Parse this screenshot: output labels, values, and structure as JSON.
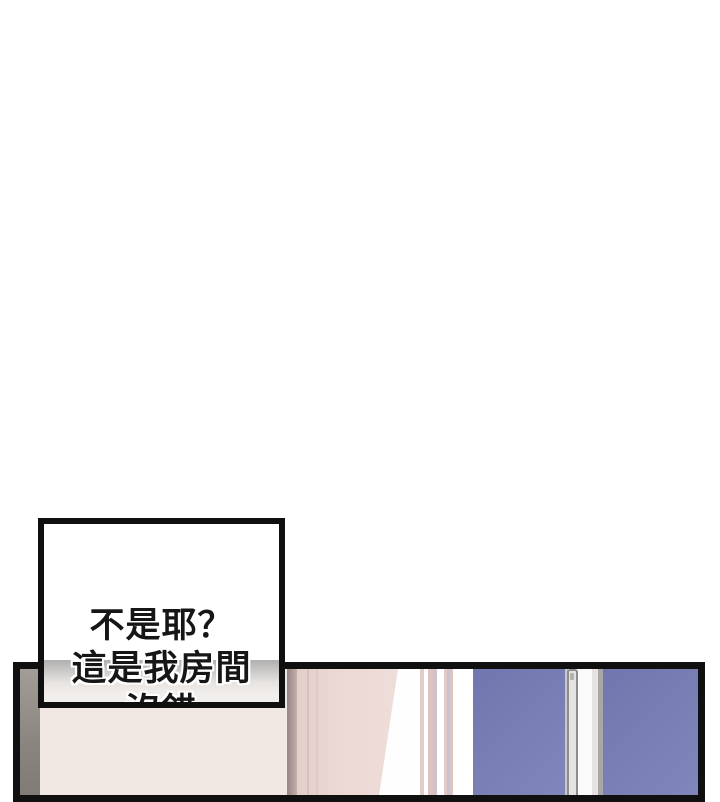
{
  "page": {
    "type": "comic-page",
    "background": "#ffffff"
  },
  "speech_bubble": {
    "lines": [
      "不是耶？",
      "這是我房間",
      "沒錯"
    ],
    "border_color": "#0f0f0f",
    "text_color": "#161616"
  },
  "panel": {
    "border_color": "#101010",
    "scene": {
      "left_wall": "shadowed-wall-edge",
      "wall": "pink-bedroom-wall",
      "curtain": "pink-striped-curtain",
      "window": "blue-window-white-frame-with-handle"
    },
    "colors": {
      "left_wall_gray": "#8a847f",
      "wall_pink": "#ecd9d5",
      "wall_shadow": "#988684",
      "curtain_stripe_pink": "#dcc4c0",
      "window_blue": "#7b81b5",
      "frame_white": "#fbfafa",
      "handle_gray": "#e5e3e1"
    }
  }
}
